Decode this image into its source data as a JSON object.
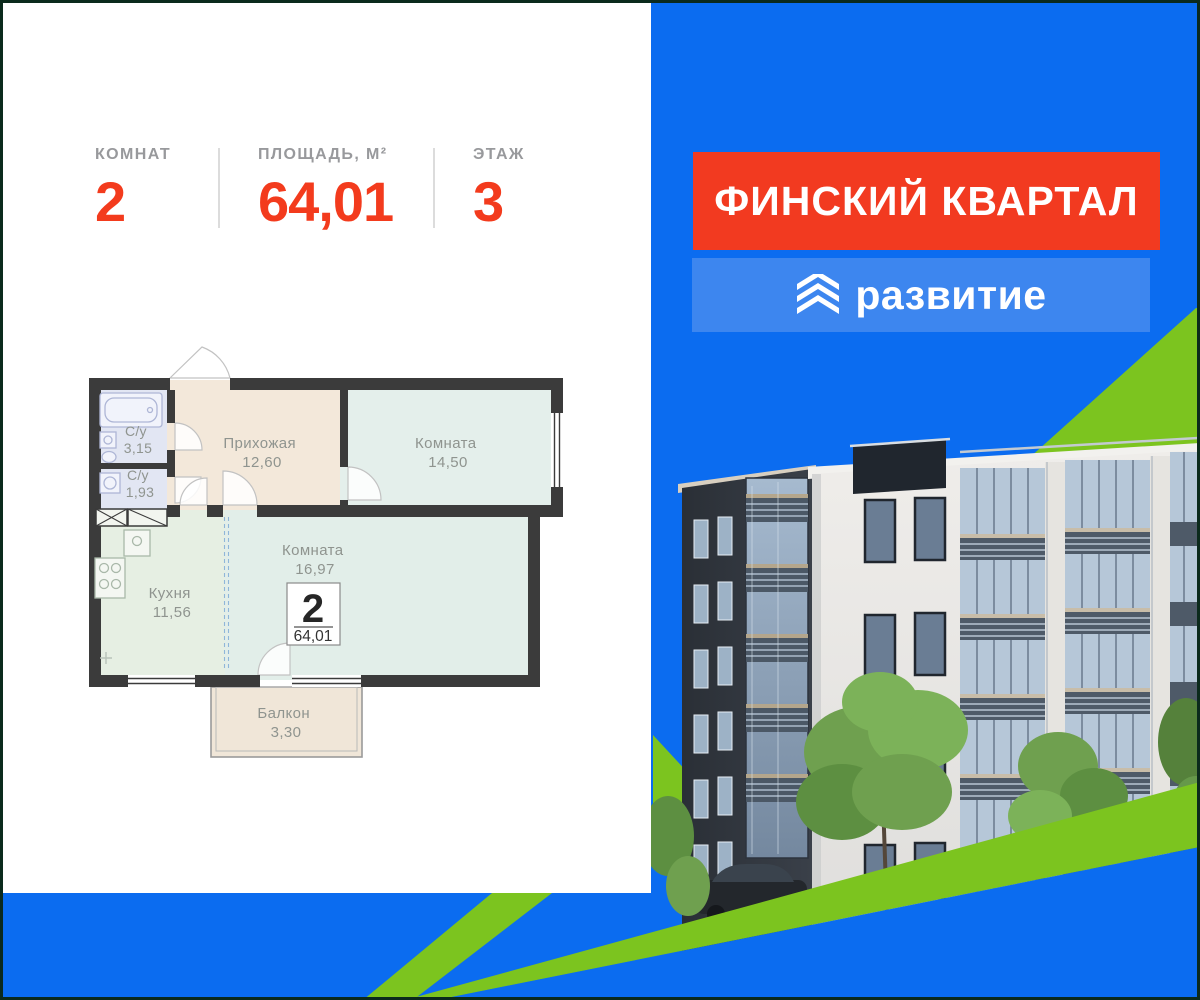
{
  "stats": {
    "items": [
      {
        "label": "КОМНАТ",
        "value": "2"
      },
      {
        "label": "ПЛОЩАДЬ, М²",
        "value": "64,01"
      },
      {
        "label": "ЭТАЖ",
        "value": "3"
      }
    ]
  },
  "branding": {
    "project": "ФИНСКИЙ КВАРТАЛ",
    "developer": "развитие",
    "logo_icon": "triple-chevron-icon"
  },
  "plan": {
    "rooms": {
      "wc1": {
        "name": "С/у",
        "area": "3,15"
      },
      "wc2": {
        "name": "С/у",
        "area": "1,93"
      },
      "hall": {
        "name": "Прихожая",
        "area": "12,60"
      },
      "room1": {
        "name": "Комната",
        "area": "14,50"
      },
      "room2": {
        "name": "Комната",
        "area": "16,97"
      },
      "kitchen": {
        "name": "Кухня",
        "area": "11,56"
      },
      "balcony": {
        "name": "Балкон",
        "area": "3,30"
      }
    },
    "summary": {
      "rooms": "2",
      "total_area": "64,01"
    }
  },
  "colors": {
    "background_blue": "#0b6cf0",
    "accent_green": "#7cc41f",
    "banner_red": "#f23a20",
    "banner_light_blue": "#3d86ef",
    "stat_value_red": "#f33b1d",
    "plan_wall": "#3b3b3b",
    "frame_dark": "#0b2a1c"
  }
}
